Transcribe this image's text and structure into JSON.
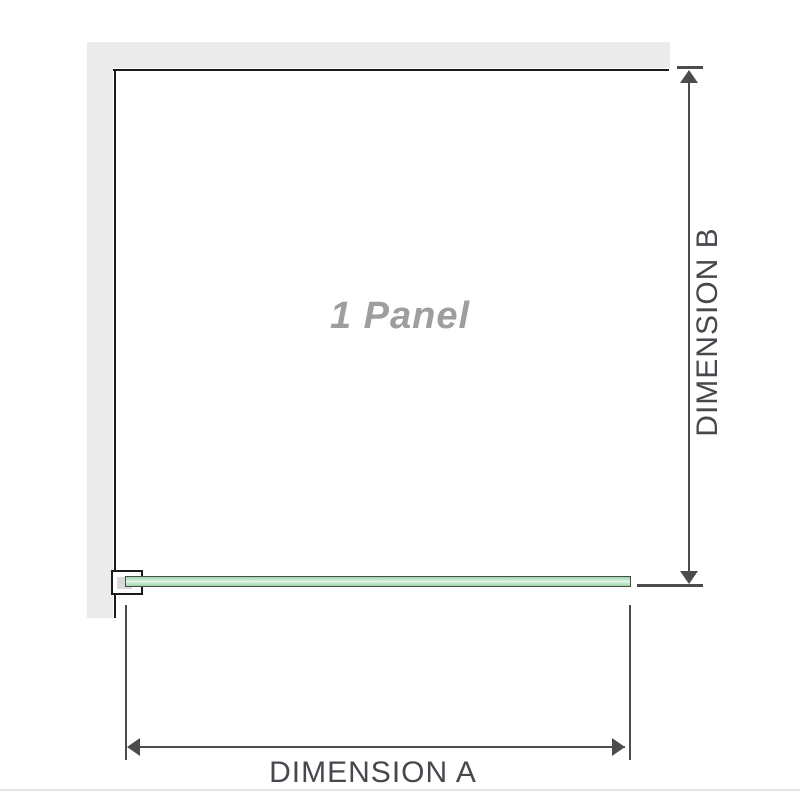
{
  "diagram": {
    "panel_label": "1 Panel",
    "dimension_a_label": "DIMENSION A",
    "dimension_b_label": "DIMENSION B"
  },
  "colors": {
    "wall": "#ebebeb",
    "outline": "#1a1a1a",
    "dimension": "#4a4c4e",
    "label": "#45484c",
    "panel_text": "#9e9e9e",
    "glass_border": "#454d48",
    "glass_fill": "#9ed5aa",
    "glass_highlight": "#e6f5e9",
    "baseline": "#e7e5e1"
  }
}
